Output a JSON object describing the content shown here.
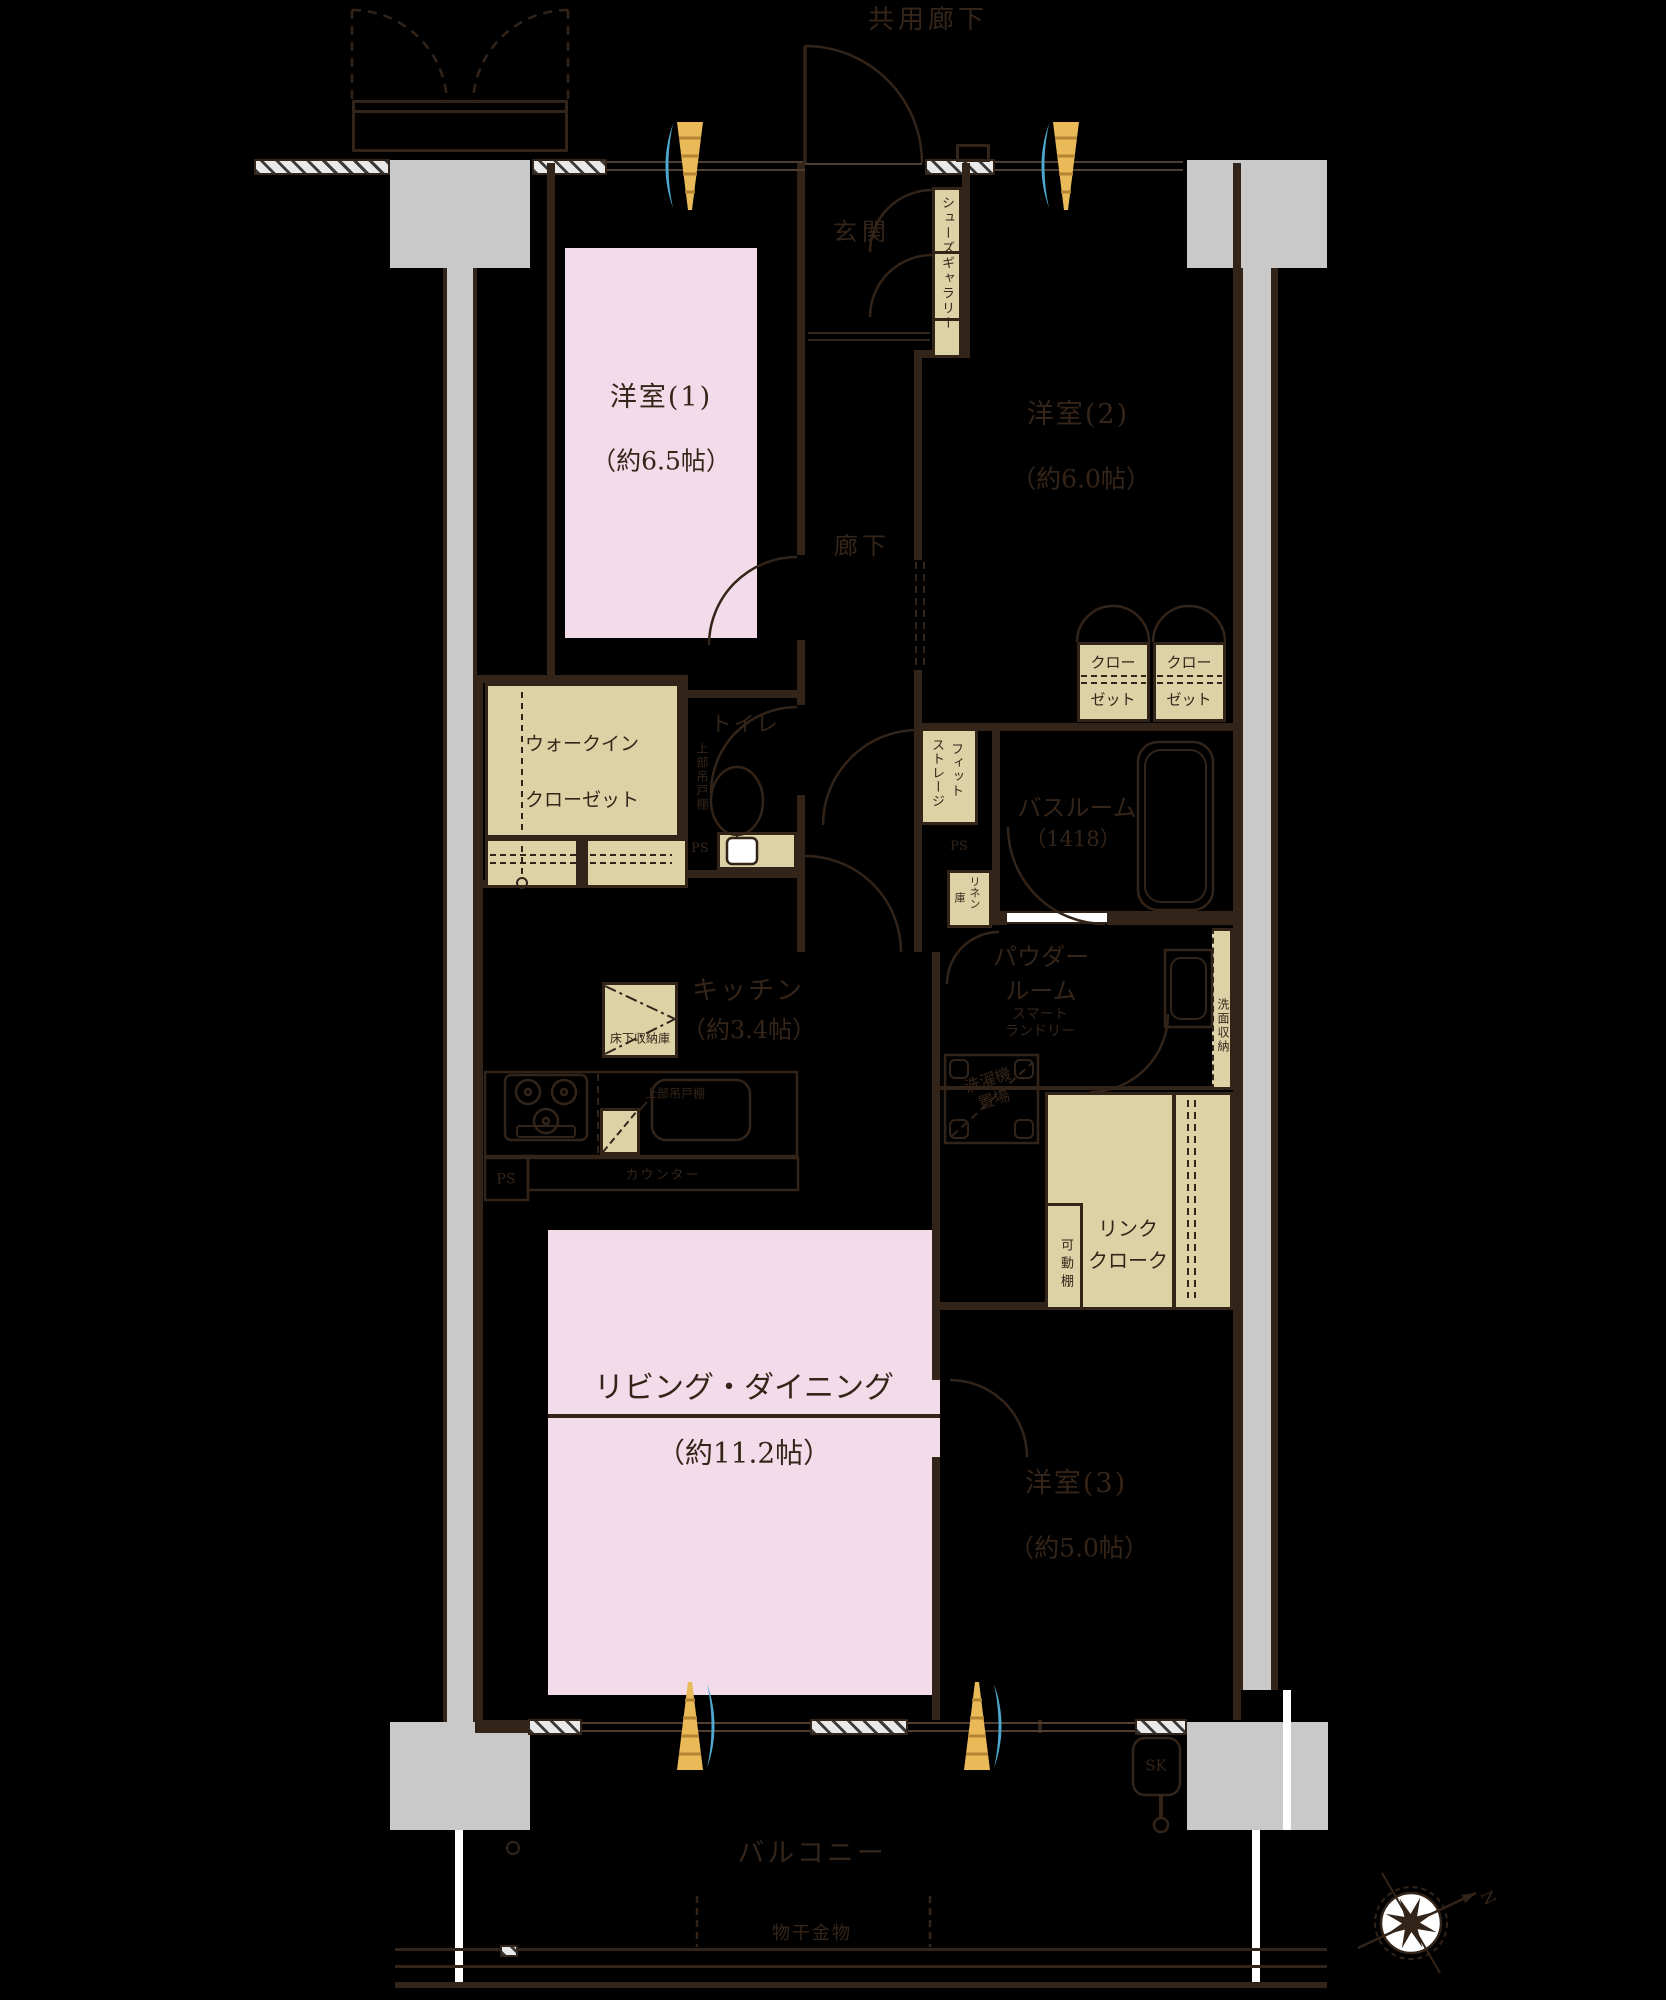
{
  "palette": {
    "line": "#332419",
    "tan_fill": "#dcd2a6",
    "pink_fill": "#f3dbea",
    "concrete_grey": "#c9c9c9",
    "airflow_blue": "#4fa8d0",
    "airflow_gold": "#e9ba57",
    "joint_white": "#ffffff"
  },
  "labels": {
    "common_corridor": "共用廊下",
    "entrance": "玄関",
    "shoe_gallery": "シューズギャラリー",
    "room1": {
      "name": "洋室(1)",
      "size": "（約6.5帖）"
    },
    "room2": {
      "name": "洋室(2)",
      "size": "（約6.0帖）"
    },
    "room3": {
      "name": "洋室(3)",
      "size": "（約5.0帖）"
    },
    "living": {
      "name": "リビング・ダイニング",
      "size": "（約11.2帖）"
    },
    "kitchen": {
      "name": "キッチン",
      "size": "（約3.4帖）"
    },
    "corridor": "廊下",
    "closet": [
      "クロー",
      "ゼット"
    ],
    "wic": [
      "ウォークイン",
      "クローゼット"
    ],
    "toilet": "トイレ",
    "upper_cabinet": "上部吊戸棚",
    "ps": "PS",
    "fit_storage": [
      "フィット",
      "ストレージ"
    ],
    "linen": [
      "リネン",
      "庫"
    ],
    "bathroom": {
      "name": "バスルーム",
      "size": "（1418）"
    },
    "powder": [
      "パウダー",
      "ルーム"
    ],
    "smart_laundry": [
      "スマート",
      "ランドリー"
    ],
    "washer": [
      "洗濯機",
      "置場"
    ],
    "vanity_storage": "洗面収納",
    "link_cloak": [
      "リンク",
      "クローク"
    ],
    "movable_shelf": "可動棚",
    "underfloor": "床下収納庫",
    "counter": "カウンター",
    "balcony": "バルコニー",
    "drying_fixture": "物干金物",
    "sk": "SK",
    "north": "N"
  }
}
